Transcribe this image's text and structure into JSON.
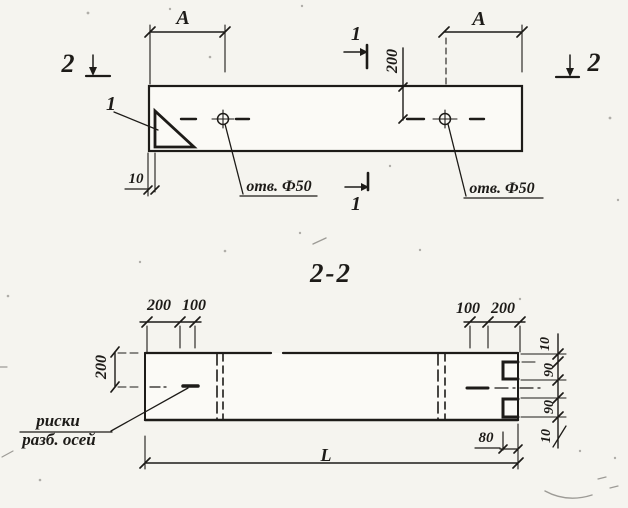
{
  "drawing": {
    "section_title": "2-2",
    "colors": {
      "paper": "#f5f4ef",
      "ink": "#1d1b18"
    },
    "top_view": {
      "dim_a_left": "A",
      "dim_a_right": "A",
      "section_mark_2_left": "2",
      "section_mark_2_right": "2",
      "section_mark_1_top": "1",
      "section_mark_1_bottom": "1",
      "detail_callout": "1",
      "dim_200_to_hole": "200",
      "dim_10_plate": "10",
      "hole_label_left": "отв. Ф50",
      "hole_label_right": "отв. Ф50"
    },
    "section_view": {
      "dim_200_top_left": "200",
      "dim_100_top_left": "100",
      "dim_100_top_right": "100",
      "dim_200_top_right": "200",
      "dim_200_height": "200",
      "axis_note_line1": "риски",
      "axis_note_line2": "разб. осей",
      "dim_length": "L",
      "dim_80": "80",
      "right_dims": [
        "10",
        "90",
        "90",
        "10"
      ]
    }
  }
}
